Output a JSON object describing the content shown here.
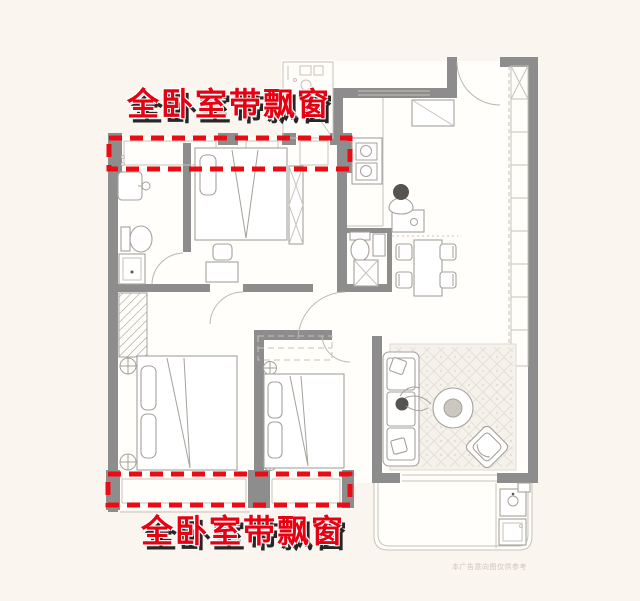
{
  "annotations": {
    "top_label": "全卧室带飘窗",
    "bottom_label": "全卧室带飘窗",
    "watermark": "本广告意向图仅供参考"
  },
  "colors": {
    "background": "#faf5ee",
    "wall": "#8d8d8d",
    "highlight_red": "#ee0a13",
    "label_red": "#e60012",
    "label_shadow": "#262626"
  },
  "icons": {
    "bed": "double-bed-icon",
    "sofa": "sofa-icon",
    "coffee_table": "coffee-table-icon",
    "armchair": "armchair-icon",
    "dining_table": "dining-table-icon",
    "stove": "stove-icon",
    "toilet": "toilet-icon",
    "sink": "sink-icon",
    "washer": "washing-machine-icon",
    "wardrobe": "wardrobe-icon",
    "person": "person-icon"
  }
}
